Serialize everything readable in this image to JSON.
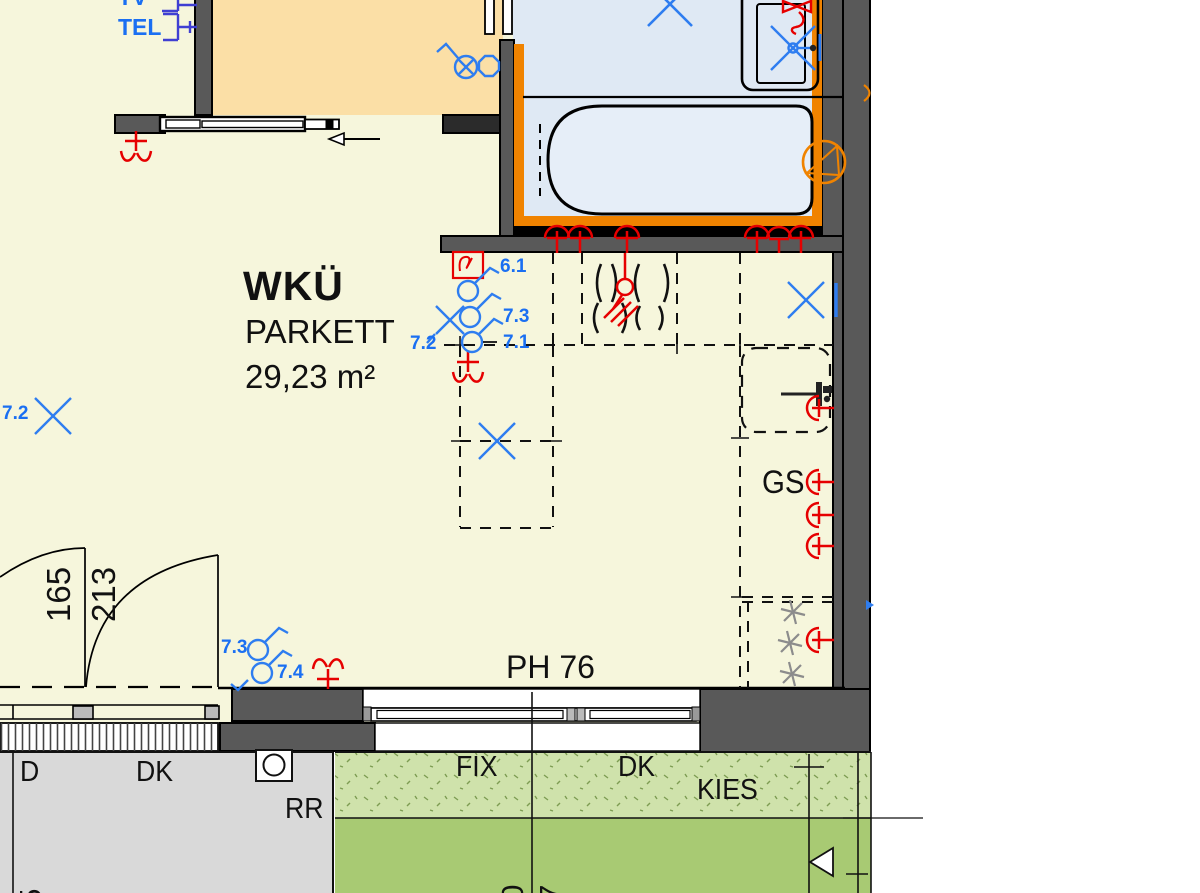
{
  "room": {
    "name": "WKÜ",
    "floor": "PARKETT",
    "area": "29,23 m²"
  },
  "outlets_top_left": {
    "tv": "TV",
    "tel": "TEL"
  },
  "circuits": {
    "c61": "6.1",
    "c71": "7.1",
    "c72": "7.2",
    "c73": "7.3",
    "c74": "7.4"
  },
  "kitchen": {
    "dishwasher": "GS"
  },
  "window": {
    "parapet": "PH 76",
    "fix": "FIX",
    "tilt": "DK",
    "gravel": "KIES"
  },
  "terrace": {
    "door": "D",
    "tilt_door": "DK",
    "rain_pipe": "RR"
  },
  "dimensions": {
    "door_leaf_left": "165",
    "door_leaf_right": "213",
    "bottom_left": "25",
    "bottom_mid_left": "10",
    "bottom_mid_right": "47",
    "bottom_right": "5"
  },
  "colors": {
    "floor_cream": "#f6f6dc",
    "room_orange": "#fbdfa6",
    "bath_blue": "#dfe9f4",
    "wall_gray": "#595959",
    "accent_orange": "#f08300",
    "terrace_gray": "#d9d9d9",
    "gravel_green": "#cfe2ab",
    "lawn_green": "#a8ca73",
    "symbol_blue": "#2e7df0",
    "symbol_red": "#e60000"
  },
  "symbols": {
    "legend": [
      {
        "name": "ceiling-outlet-icon",
        "color": "#e60000"
      },
      {
        "name": "wall-socket-icon",
        "color": "#e60000"
      },
      {
        "name": "thermostat-icon",
        "color": "#e60000",
        "glyph": "ϑ"
      },
      {
        "name": "ceiling-lamp-x-icon",
        "color": "#2e7df0"
      },
      {
        "name": "switch-icon",
        "color": "#2e7df0"
      },
      {
        "name": "cooktop-burners-icon",
        "color": "#111111"
      },
      {
        "name": "bathtub-icon",
        "color": "#111111"
      },
      {
        "name": "washbasin-icon",
        "color": "#111111"
      },
      {
        "name": "pump-circle-icon",
        "color": "#f08300"
      }
    ]
  }
}
